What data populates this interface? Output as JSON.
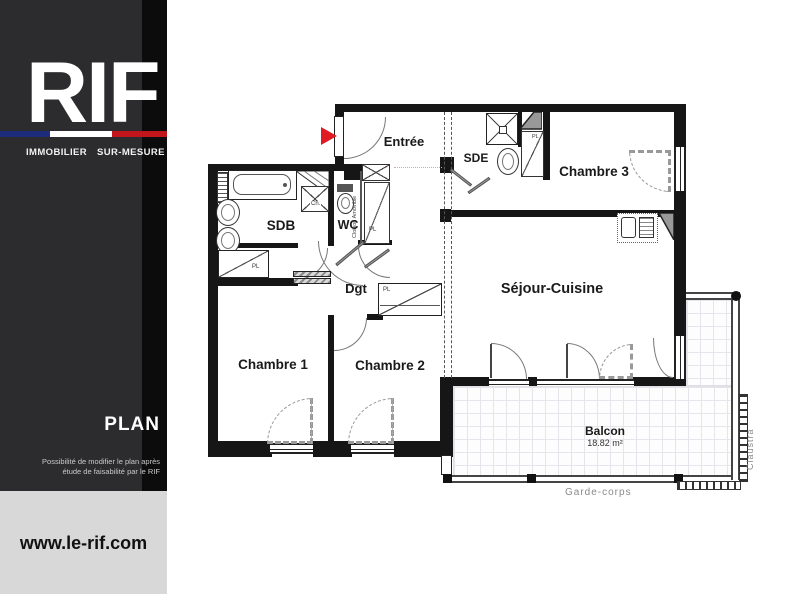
{
  "sidebar": {
    "logo": "RIF",
    "tagline": "IMMOBILIER SUR-MESURE",
    "section_title": "PLAN",
    "note_line1": "Possibilité de modifier le plan après",
    "note_line2": "étude de faisabilité par le RIF",
    "website": "www.le-rif.com",
    "colors": {
      "panel_dark": "#2c2c2e",
      "panel_black": "#0c0c0d",
      "panel_light": "#d8d8d8",
      "flag_blue": "#1d2c7c",
      "flag_white": "#ffffff",
      "flag_red": "#c3161c"
    }
  },
  "plan": {
    "rooms": {
      "entree": {
        "label": "Entrée"
      },
      "sde": {
        "label": "SDE"
      },
      "chambre3": {
        "label": "Chambre 3"
      },
      "sdb": {
        "label": "SDB"
      },
      "wc": {
        "label": "WC"
      },
      "dgt": {
        "label": "Dgt"
      },
      "sejour": {
        "label": "Séjour-Cuisine"
      },
      "chambre1": {
        "label": "Chambre 1"
      },
      "chambre2": {
        "label": "Chambre 2"
      },
      "balcon": {
        "label": "Balcon",
        "area": "18.82 m²"
      }
    },
    "annotations": {
      "garde_corps": "Garde-corps",
      "claustra": "Claustra",
      "cloison_amovible": "Cloison Amovible",
      "placard": "PL",
      "chauffe_eau": "Ch."
    },
    "colors": {
      "wall": "#161616",
      "entrance_arrow": "#e01b24"
    }
  }
}
